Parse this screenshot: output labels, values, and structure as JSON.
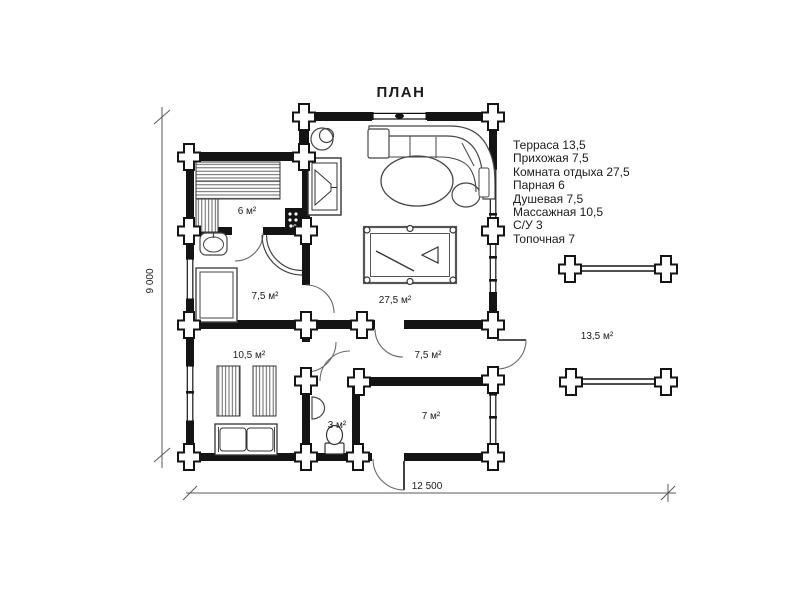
{
  "title": "ПЛАН",
  "legend": {
    "items": [
      "Терраса 13,5",
      "Прихожая 7,5",
      "Комната отдыха 27,5",
      "Парная 6",
      "Душевая 7,5",
      "Массажная 10,5",
      "С/У 3",
      "Топочная 7"
    ]
  },
  "rooms": {
    "sauna": {
      "name": "Парная",
      "area_label": "6 м²"
    },
    "shower": {
      "name": "Душевая",
      "area_label": "7,5 м²"
    },
    "lounge": {
      "name": "Комната отдыха",
      "area_label": "27,5 м²"
    },
    "hall": {
      "name": "Прихожая",
      "area_label": "7,5 м²"
    },
    "massage": {
      "name": "Массажная",
      "area_label": "10,5 м²"
    },
    "wc": {
      "name": "С/У",
      "area_label": "3 м²"
    },
    "boiler": {
      "name": "Топочная",
      "area_label": "7 м²"
    },
    "terrace": {
      "name": "Терраса",
      "area_label": "13,5 м²"
    }
  },
  "dimensions": {
    "overall_width_mm": "12 500",
    "overall_height_mm": "9 000"
  },
  "colors": {
    "wall": "#141414",
    "furniture": "#454545",
    "text": "#1b1b1b",
    "dimension": "#5a5a5a",
    "background": "#ffffff"
  }
}
